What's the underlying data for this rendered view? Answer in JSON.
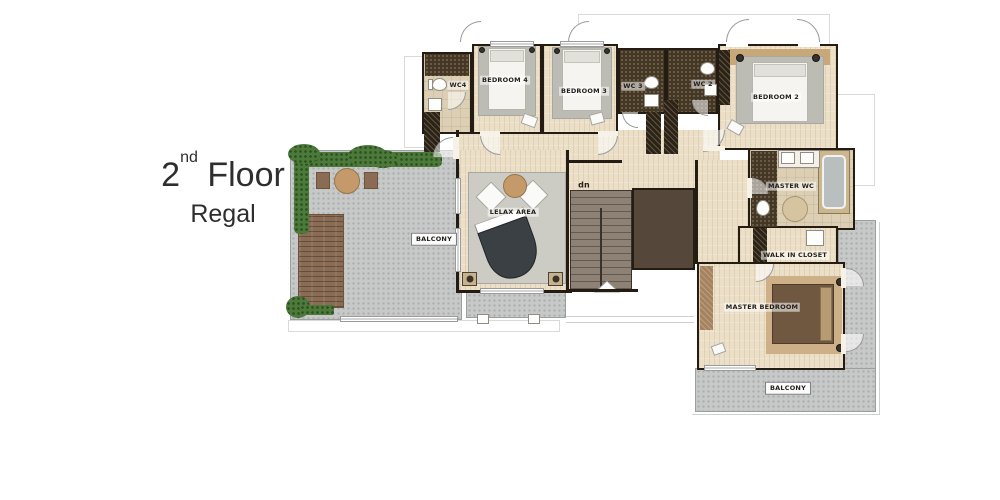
{
  "title": {
    "floor_number": "2",
    "ordinal": "nd",
    "floor_word": "Floor",
    "name": "Regal"
  },
  "plan": {
    "rooms": {
      "wc4": {
        "label": "WC4"
      },
      "bedroom_4": {
        "label": "BEDROOM 4"
      },
      "bedroom_3": {
        "label": "BEDROOM 3"
      },
      "wc3": {
        "label": "WC 3"
      },
      "wc2": {
        "label": "WC 2"
      },
      "bedroom_2": {
        "label": "BEDROOM 2"
      },
      "master_wc": {
        "label": "MASTER WC"
      },
      "walk_in_closet": {
        "label": "WALK IN CLOSET"
      },
      "master_bedroom": {
        "label": "MASTER BEDROOM"
      },
      "relax_area": {
        "label": "LELAX AREA"
      },
      "balcony_left": {
        "label": "BALCONY"
      },
      "balcony_master": {
        "label": "BALCONY"
      },
      "stairs": {
        "label": "dn"
      }
    },
    "colors": {
      "wall": "#241c12",
      "wood_floor": "#ebdfc7",
      "concrete": "#c7c9c8",
      "mosaic_tile": "#443726",
      "hedge_green": "#4d7a3b",
      "deck_wood": "#8a6b53",
      "piano": "#3b4045",
      "master_bed": "#6f5740",
      "headboard_tan": "#c8a878"
    }
  }
}
